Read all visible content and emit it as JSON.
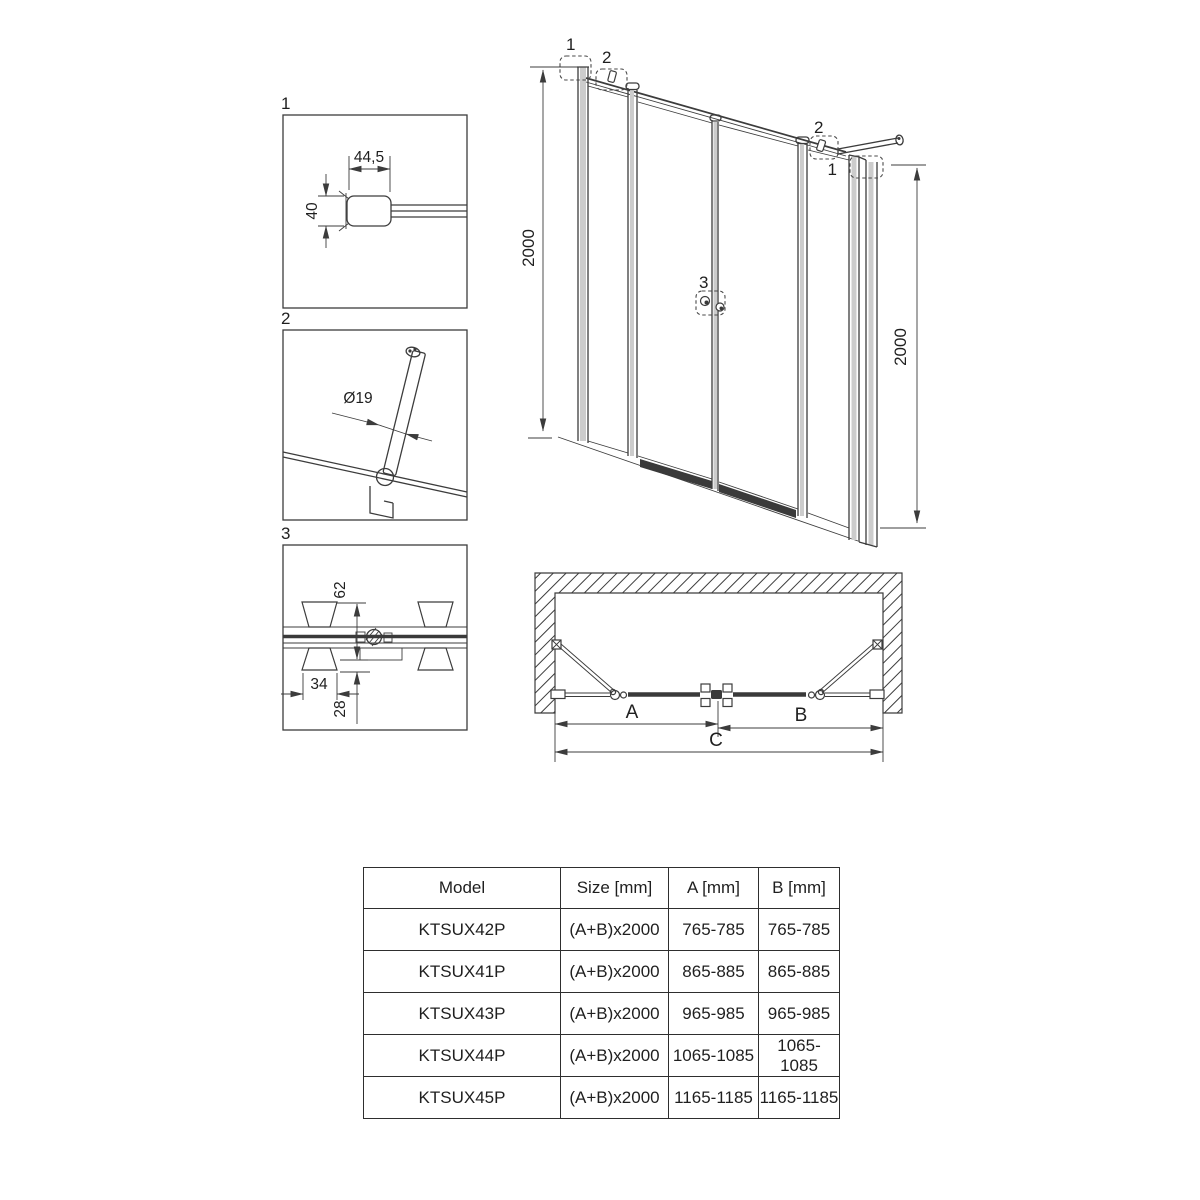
{
  "drawing": {
    "details": {
      "d1": {
        "label": "1",
        "dim_width": "44,5",
        "dim_height": "40"
      },
      "d2": {
        "label": "2",
        "dim_diameter": "Ø19"
      },
      "d3": {
        "label": "3",
        "dim_depth": "62",
        "dim_width": "34",
        "dim_offset": "28"
      }
    },
    "elevation": {
      "callout_wall_left": "1",
      "callout_bar_left": "2",
      "callout_bar_right": "2",
      "callout_wall_right": "1",
      "callout_handle": "3",
      "dim_height_left": "2000",
      "dim_height_right": "2000"
    },
    "plan": {
      "dim_a": "A",
      "dim_b": "B",
      "dim_c": "C"
    }
  },
  "table": {
    "headers": [
      "Model",
      "Size [mm]",
      "A [mm]",
      "B [mm]"
    ],
    "rows": [
      [
        "KTSUX42P",
        "(A+B)x2000",
        "765-785",
        "765-785"
      ],
      [
        "KTSUX41P",
        "(A+B)x2000",
        "865-885",
        "865-885"
      ],
      [
        "KTSUX43P",
        "(A+B)x2000",
        "965-985",
        "965-985"
      ],
      [
        "KTSUX44P",
        "(A+B)x2000",
        "1065-1085",
        "1065-1085"
      ],
      [
        "KTSUX45P",
        "(A+B)x2000",
        "1165-1185",
        "1165-1185"
      ]
    ]
  },
  "colors": {
    "line": "#3c3c3c",
    "dark_fill": "#3a3a3a",
    "text": "#1f1f1f"
  }
}
